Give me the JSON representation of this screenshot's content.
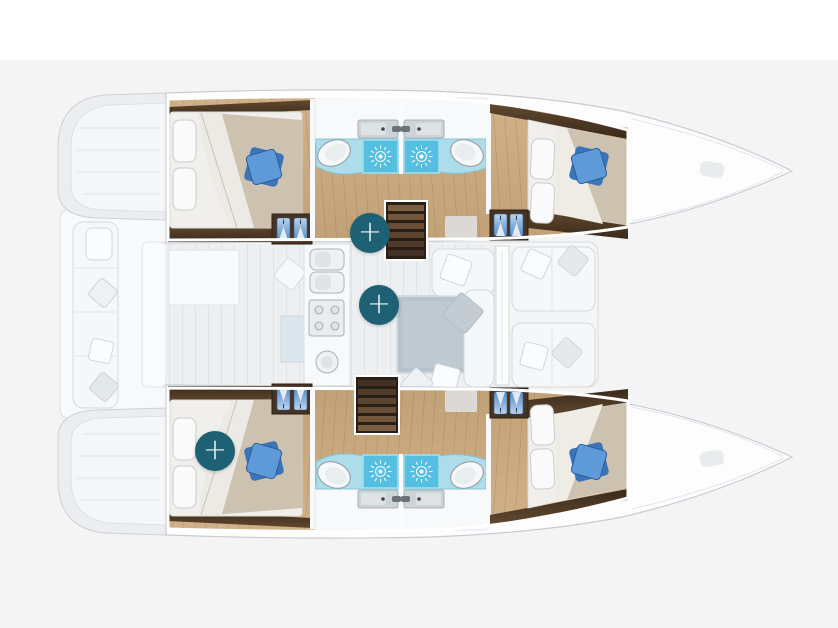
{
  "canvas": {
    "top_band_color": "#ffffff",
    "background_color": "#f4f4f5"
  },
  "floorplan": {
    "vessel": "catamaran",
    "view": "top-down-deck-plan",
    "accent_color": "#1e6074",
    "hotspots": [
      {
        "name": "hotspot-port-hull",
        "symbol": "+",
        "cx": 370,
        "cy": 233
      },
      {
        "name": "hotspot-saloon",
        "symbol": "+",
        "cx": 379,
        "cy": 305
      },
      {
        "name": "hotspot-starboard-aft-cabin",
        "symbol": "+",
        "cx": 215,
        "cy": 451
      }
    ],
    "areas": [
      "port-aft-cabin",
      "port-bathrooms",
      "port-fore-cabin",
      "starboard-aft-cabin",
      "starboard-bathrooms",
      "starboard-fore-cabin",
      "saloon",
      "galley",
      "dining-table",
      "aft-cockpit",
      "forward-cockpit",
      "port-companionway-stairs",
      "starboard-companionway-stairs"
    ],
    "palette": {
      "wood_floor": "#c9a87e",
      "dark_wood_trim": "#4a3626",
      "bathroom_tile": "#aedcec",
      "shower_tile": "#57c0e3",
      "blue_pillow": "#4e8fd0",
      "sofa_white": "#f5f6f7",
      "table_grey": "#b9c4cb",
      "hull_outline": "#c6ccd3"
    }
  }
}
